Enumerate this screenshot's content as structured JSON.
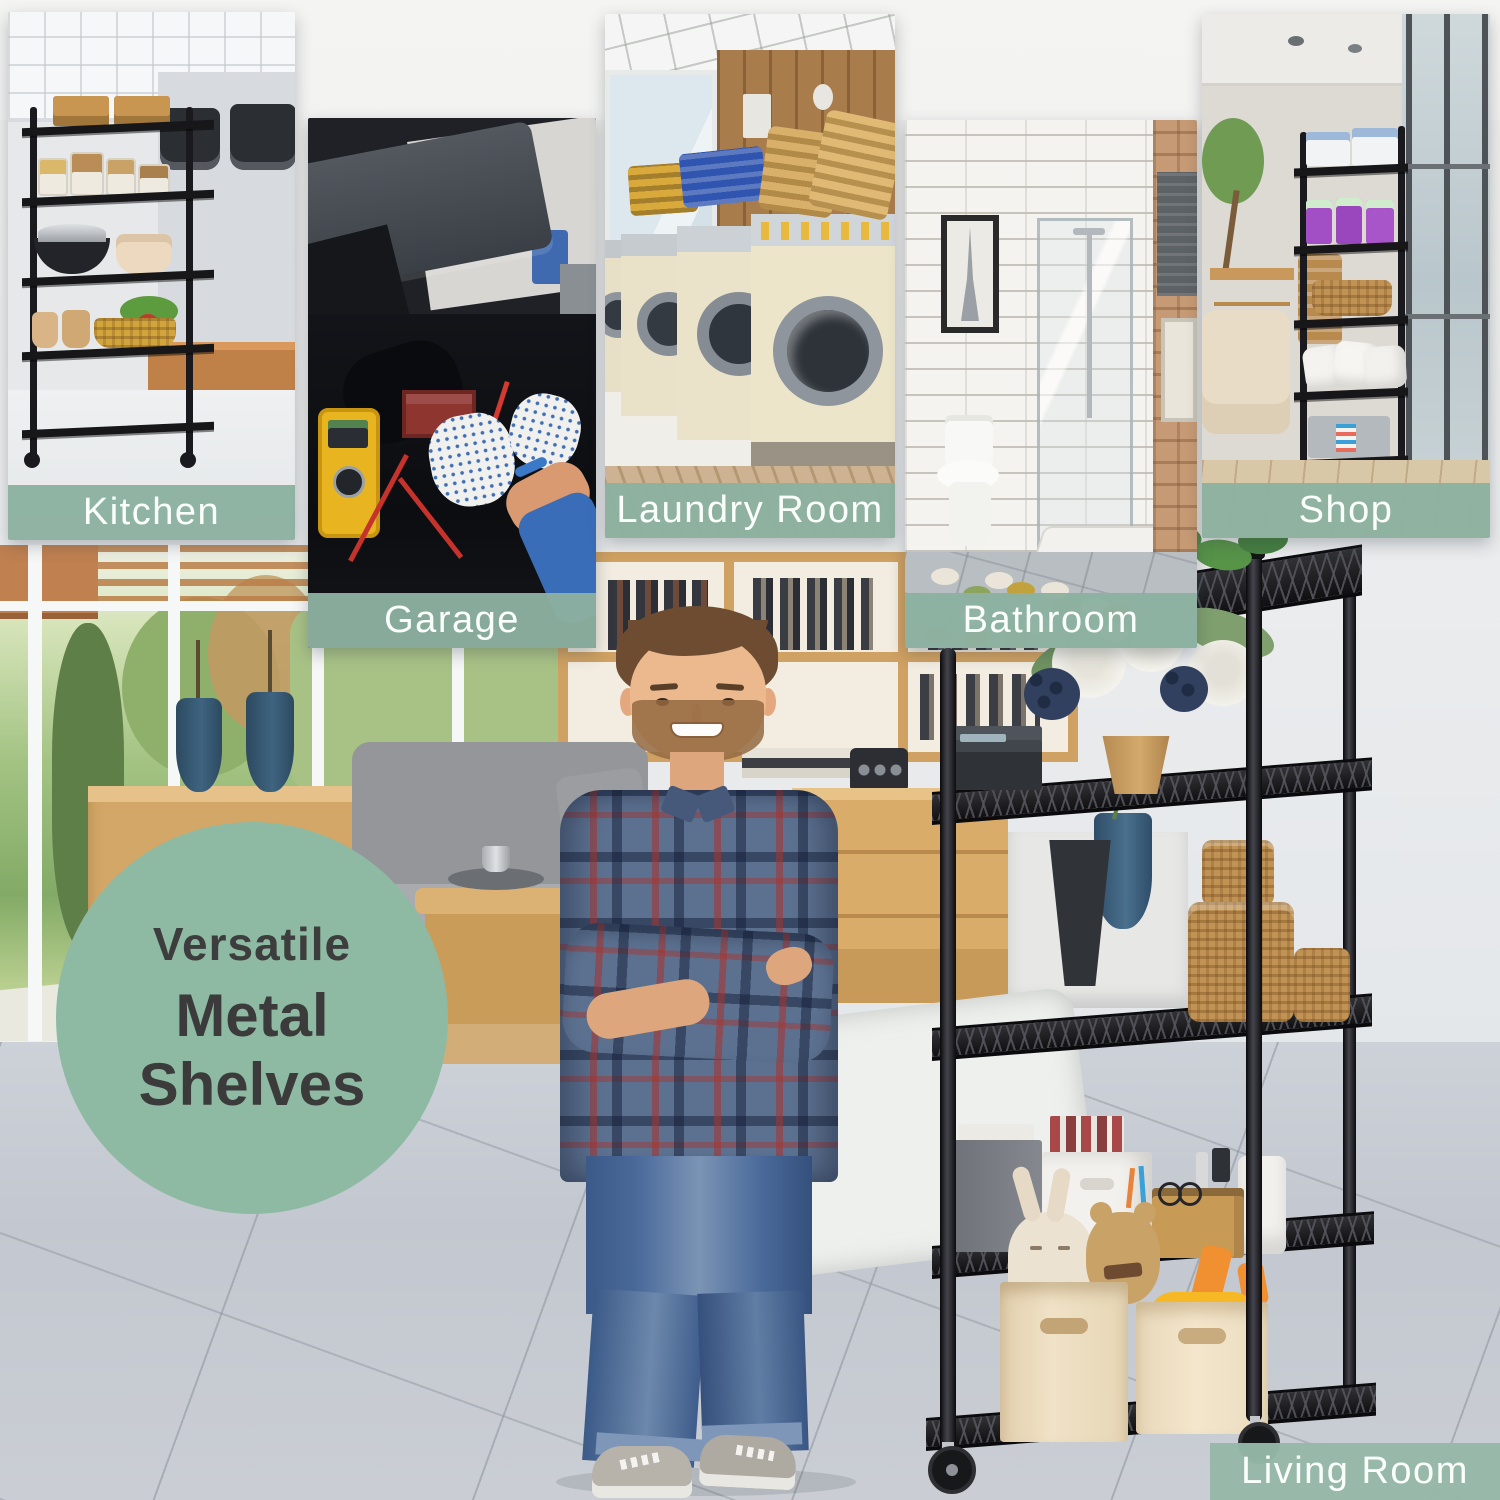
{
  "collage": {
    "badge": {
      "line1": "Versatile",
      "line2": "Metal Shelves"
    },
    "panels": [
      {
        "key": "kitchen",
        "label": "Kitchen"
      },
      {
        "key": "garage",
        "label": "Garage"
      },
      {
        "key": "laundry-room",
        "label": "Laundry Room"
      },
      {
        "key": "bathroom",
        "label": "Bathroom"
      },
      {
        "key": "shop",
        "label": "Shop"
      }
    ],
    "floor_label": "Living Room",
    "colors": {
      "label_band_green": "#8db1a0",
      "badge_circle_green": "#8ebaa3",
      "band_text": "#fbfffc",
      "badge_text": "#3b3b3b",
      "shelf_black": "#1d1d1f"
    }
  }
}
